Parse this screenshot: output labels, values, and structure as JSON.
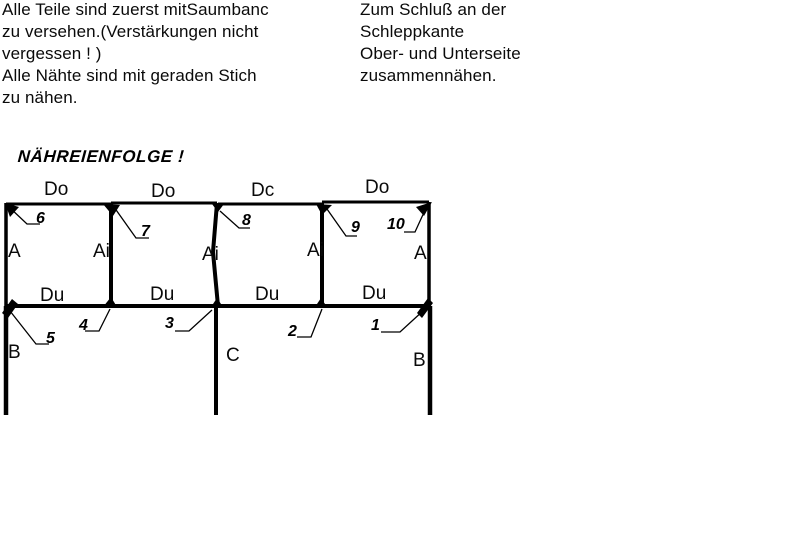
{
  "instructions_left": {
    "lines": [
      "Alle Teile sind zuerst mitSaumbanc",
      "zu versehen.(Verstärkungen nicht",
      "vergessen ! )",
      "Alle Nähte sind mit geraden Stich",
      "zu nähen."
    ]
  },
  "instructions_right": {
    "lines": [
      "Zum Schluß an der",
      "Schleppkante",
      "Ober- und Unterseite",
      "zusammennähen."
    ]
  },
  "heading": "NÄHREIENFOLGE !",
  "diagram": {
    "panel_top_labels": [
      "Do",
      "Do",
      "Dc",
      "Do"
    ],
    "side_labels": {
      "left_a": "A",
      "ai_1": "Ai",
      "ai_2": "Ai",
      "ai_3": "Ai",
      "right_a": "A"
    },
    "du_labels": [
      "Du",
      "Du",
      "Du",
      "Du"
    ],
    "steps": {
      "s1": "1",
      "s2": "2",
      "s3": "3",
      "s4": "4",
      "s5": "5",
      "s6": "6",
      "s7": "7",
      "s8": "8",
      "s9": "9",
      "s10": "10"
    },
    "corner_letters": {
      "b_left": "B",
      "c_mid": "C",
      "b_right": "B"
    }
  },
  "colors": {
    "ink": "#000000",
    "background": "#ffffff"
  }
}
